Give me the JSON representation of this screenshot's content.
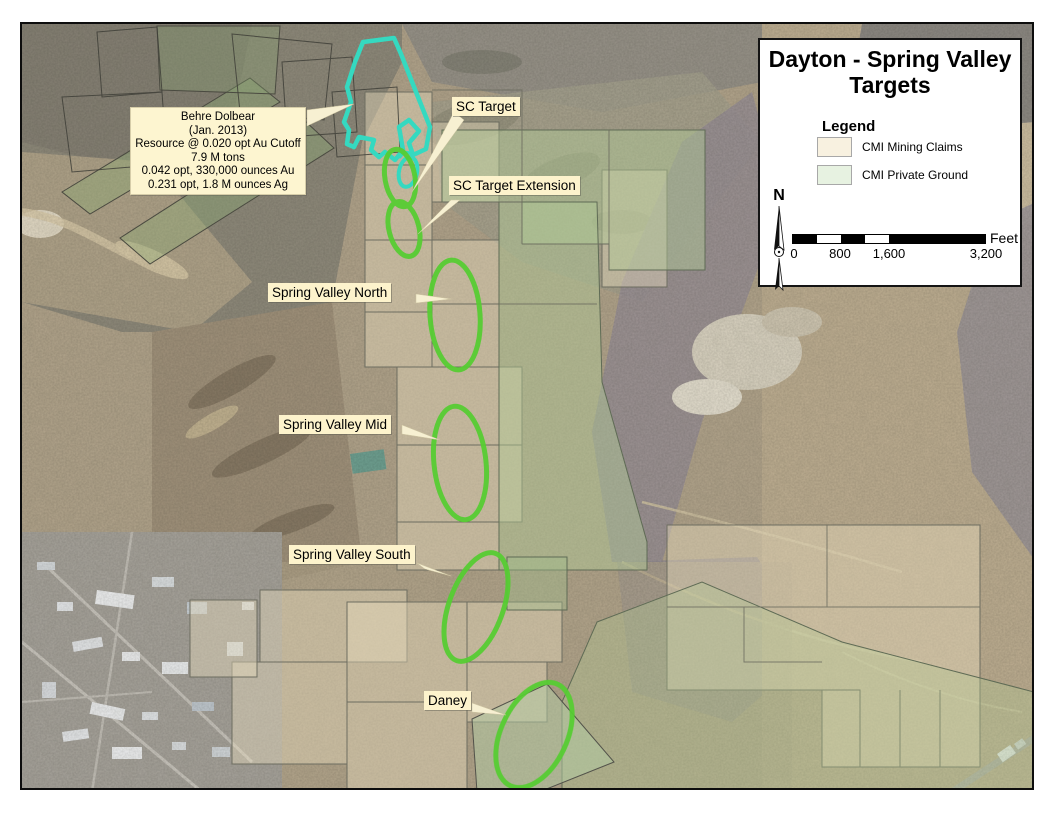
{
  "page_title": "Dayton - Spring Valley Targets",
  "title_box": {
    "title": "Dayton - Spring Valley Targets",
    "legend": {
      "heading": "Legend",
      "items": [
        {
          "label": "CMI Mining Claims",
          "swatch_color": "#f8f1e0"
        },
        {
          "label": "CMI Private Ground",
          "swatch_color": "#e7f2e1"
        }
      ]
    },
    "north_label": "N",
    "scale_bar": {
      "ticks": [
        "0",
        "800",
        "1,600",
        "3,200"
      ],
      "unit": "Feet"
    }
  },
  "callout": {
    "lines": [
      "Behre Dolbear",
      "(Jan. 2013)",
      "Resource @ 0.020 opt Au Cutoff",
      "7.9 M tons",
      "0.042 opt, 330,000 ounces Au",
      "0.231 opt, 1.8 M ounces Ag"
    ]
  },
  "map_labels": {
    "sc_target": "SC Target",
    "sc_target_extension": "SC Target Extension",
    "spring_valley_north": "Spring Valley North",
    "spring_valley_mid": "Spring Valley Mid",
    "spring_valley_south": "Spring Valley South",
    "daney": "Daney"
  },
  "colors": {
    "target_ellipse_green": "#57cd33",
    "resource_outline_cyan": "#35d9c0",
    "mining_claims_overlay": "#e8dbb9",
    "private_ground_overlay": "#bcd7a2",
    "label_background": "#fdf3cc"
  }
}
